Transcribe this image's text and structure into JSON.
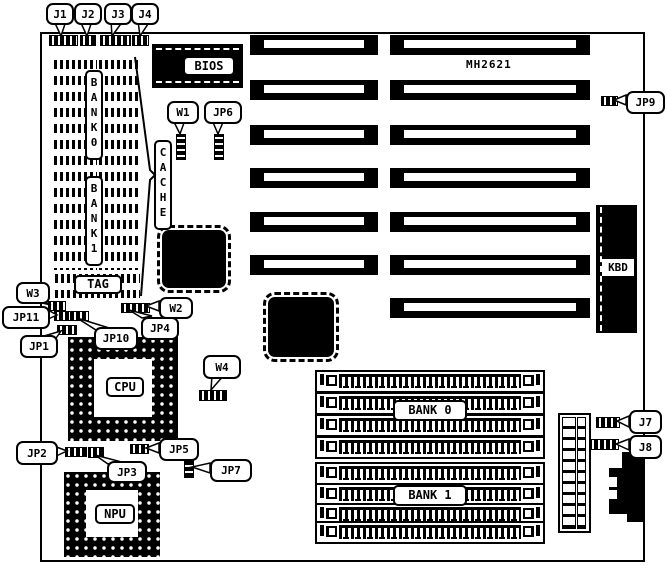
{
  "board": {
    "model": "MH2621"
  },
  "chips": {
    "bios": "BIOS",
    "cache": "CACHE",
    "tag": "TAG",
    "cpu": "CPU",
    "npu": "NPU",
    "kbd": "KBD",
    "dip_bank0": "BANK0",
    "dip_bank1": "BANK1",
    "simm_bank0": "BANK 0",
    "simm_bank1": "BANK 1"
  },
  "jumpers": {
    "j1": "J1",
    "j2": "J2",
    "j3": "J3",
    "j4": "J4",
    "j7": "J7",
    "j8": "J8",
    "jp1": "JP1",
    "jp2": "JP2",
    "jp3": "JP3",
    "jp4": "JP4",
    "jp5": "JP5",
    "jp6": "JP6",
    "jp7": "JP7",
    "jp9": "JP9",
    "jp10": "JP10",
    "jp11": "JP11",
    "w1": "W1",
    "w2": "W2",
    "w3": "W3",
    "w4": "W4"
  }
}
